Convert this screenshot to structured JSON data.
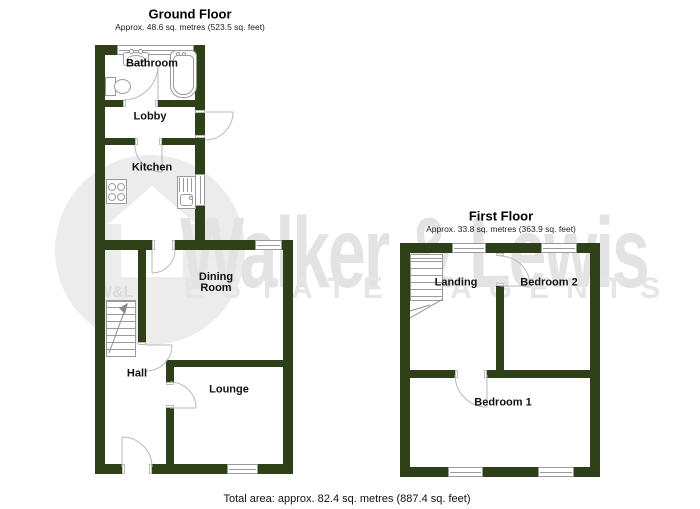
{
  "colors": {
    "wall": "#2e4018"
  },
  "ground_floor": {
    "title": "Ground Floor",
    "subtitle": "Approx. 48.6 sq. metres (523.5 sq. feet)",
    "rooms": {
      "bathroom": "Bathroom",
      "lobby": "Lobby",
      "kitchen": "Kitchen",
      "dining": "Dining Room",
      "hall": "Hall",
      "lounge": "Lounge"
    }
  },
  "first_floor": {
    "title": "First Floor",
    "subtitle": "Approx. 33.8 sq. metres (363.9 sq. feet)",
    "rooms": {
      "landing": "Landing",
      "bedroom2": "Bedroom 2",
      "bedroom1": "Bedroom 1"
    }
  },
  "footer": {
    "total_area": "Total area: approx. 82.4 sq. metres (887.4 sq. feet)"
  },
  "watermark": {
    "name": "Walker & Lewis",
    "tagline": "ESTATE AGENTS",
    "logo_text": "W&L"
  }
}
